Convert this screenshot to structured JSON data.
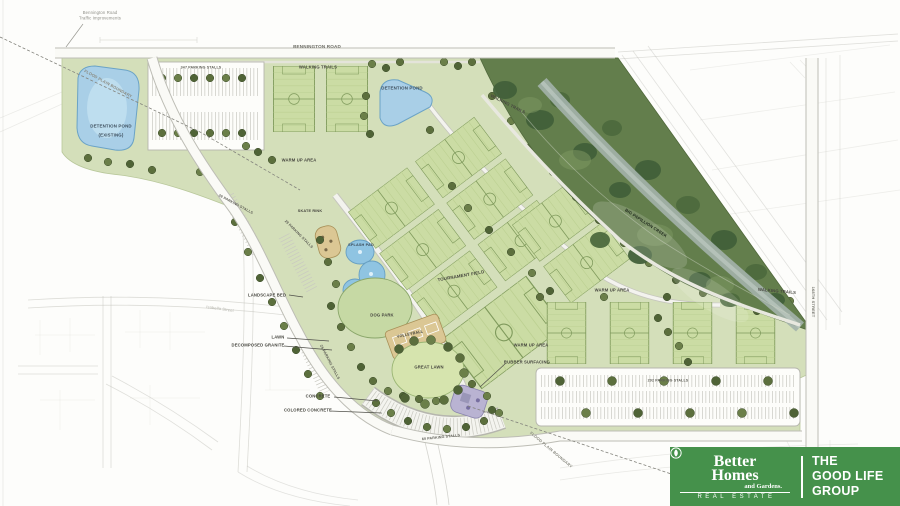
{
  "map": {
    "annotations": {
      "traffic_note_line1": "Bennington Road",
      "traffic_note_line2": "Traffic Improvements"
    },
    "roads": {
      "bennington": "BENNINGTON ROAD",
      "street_168": "168TH STREET",
      "isabella": "Isabella Street"
    },
    "labels": {
      "walking_trails": "WALKING TRAILS",
      "detention_pond": "DETENTION POND",
      "existing": "(EXISTING)",
      "warm_up": "WARM UP AREA",
      "skate_rink": "SKATE RINK",
      "splash_pad": "SPLASH PAD",
      "dog_park": "DOG PARK",
      "volleyball": "VOLLEYBALL",
      "great_lawn": "GREAT LAWN",
      "lawn": "LAWN",
      "landscape_bed": "LANDSCAPE BED",
      "decomposed_granite": "DECOMPOSED GRANITE",
      "concrete": "CONCRETE",
      "colored_concrete": "COLORED CONCRETE",
      "rubber_surfacing": "RUBBER SURFACING",
      "tournament_field": "TOURNAMENT FIELD",
      "flood_plain": "FLOOD PLAIN BOUNDARY",
      "creek": "BIG PAPILLION CREEK"
    },
    "parking": {
      "north": "347 PARKING STALLS",
      "long": "292 PARKING STALLS",
      "curve": "60 PARKING STALLS",
      "west_a": "28 PARKING STALLS",
      "west_b": "29 PARKING STALLS",
      "west_c": "25 PARKING STALLS"
    }
  },
  "logo": {
    "brand_word1": "Better",
    "brand_word2": "Homes",
    "brand_word3": "and Gardens.",
    "brand_tagline": "REAL ESTATE",
    "group_line1": "THE",
    "group_line2": "GOOD LIFE",
    "group_line3": "GROUP"
  },
  "palette": {
    "park_green": "#d4dfba",
    "field_green": "#c9daa2",
    "aerial_green": "#637e4c",
    "pond_blue": "#a9cfe7",
    "road_white": "#fafaf6",
    "logo_green": "#45914b"
  }
}
